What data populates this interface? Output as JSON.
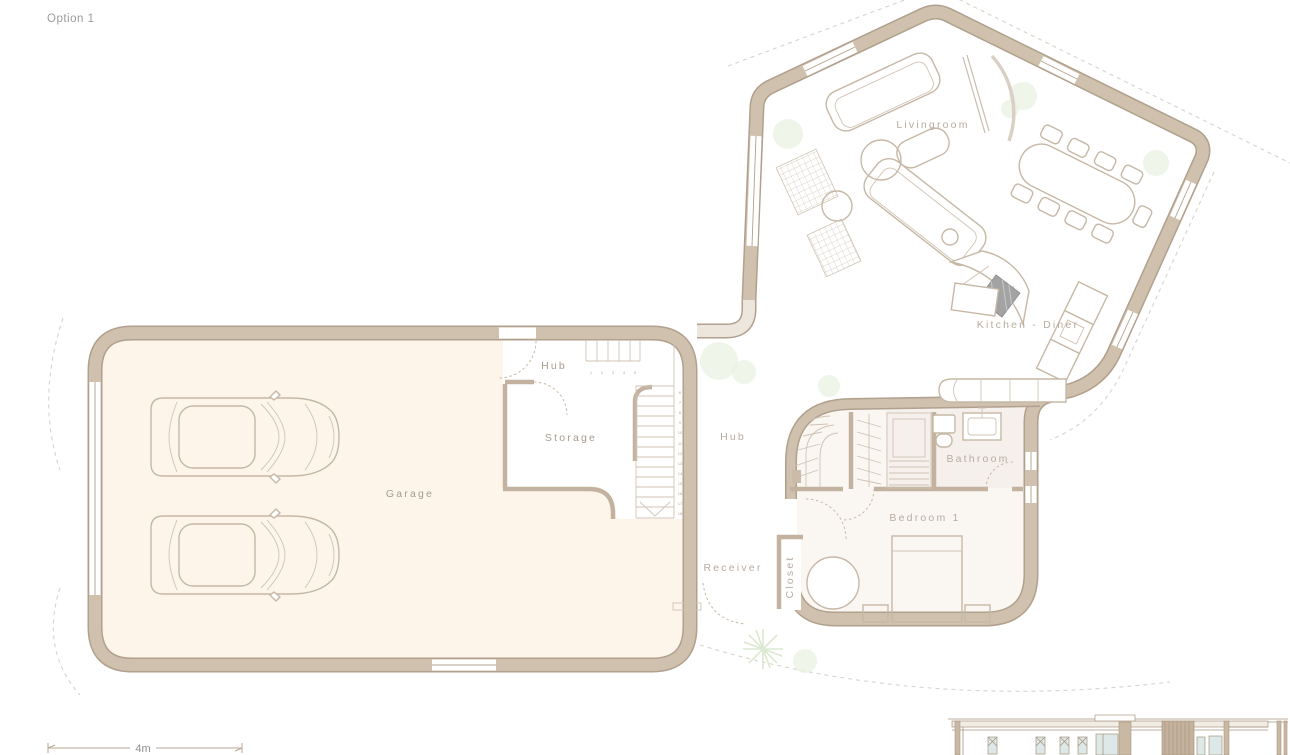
{
  "title": {
    "label": "Option 1"
  },
  "rooms": {
    "livingroom": "Livingroom",
    "kitchen": "Kitchen - Diner",
    "hub_garage": "Hub",
    "hub_corridor": "Hub",
    "storage": "Storage",
    "garage": "Garage",
    "bathroom": "Bathroom",
    "bedroom": "Bedroom 1",
    "receiver": "Receiver",
    "closet": "Closet"
  },
  "scale_bar": {
    "label": "4m"
  },
  "stairs": {
    "top_numbers": [
      "1",
      "2",
      "3",
      "4",
      "5"
    ],
    "run_numbers": [
      "6",
      "7",
      "8",
      "9",
      "10",
      "11",
      "12",
      "13",
      "14",
      "15",
      "16",
      "17",
      "18"
    ]
  },
  "colors": {
    "wall_fill": "#cfc1ae",
    "wall_edge": "#b0a08d",
    "garage_floor": "#fdf5ea",
    "bedroom_floor": "#faf7f3",
    "plant_green": "#e9f1e2",
    "label_text": "#a69b8d"
  }
}
